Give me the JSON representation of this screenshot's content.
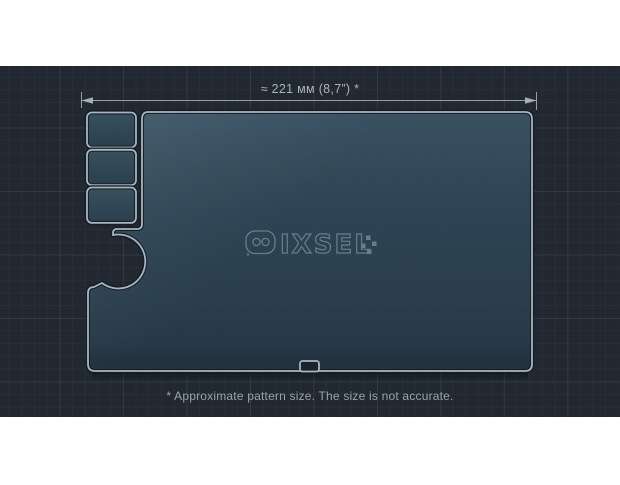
{
  "dimension": {
    "label": "≈ 221 мм (8,7”) *"
  },
  "footnote": {
    "text": "* Approximate pattern size. The size is not accurate."
  },
  "watermark": {
    "brand": "PIXSEL",
    "tail": "IXSEL"
  },
  "pattern": {
    "main_piece": "dashboard-screen-protector-outline",
    "side_cutouts": 3,
    "bottom_cutouts": 1
  },
  "colors": {
    "panel-bg": "#212831",
    "outline": "#a6b6c1",
    "dim": "#aab4be",
    "caption": "#99a3ad",
    "watermark": "#9fb9c9",
    "glass-top": "#3b5464",
    "glass-bottom": "#233240"
  }
}
